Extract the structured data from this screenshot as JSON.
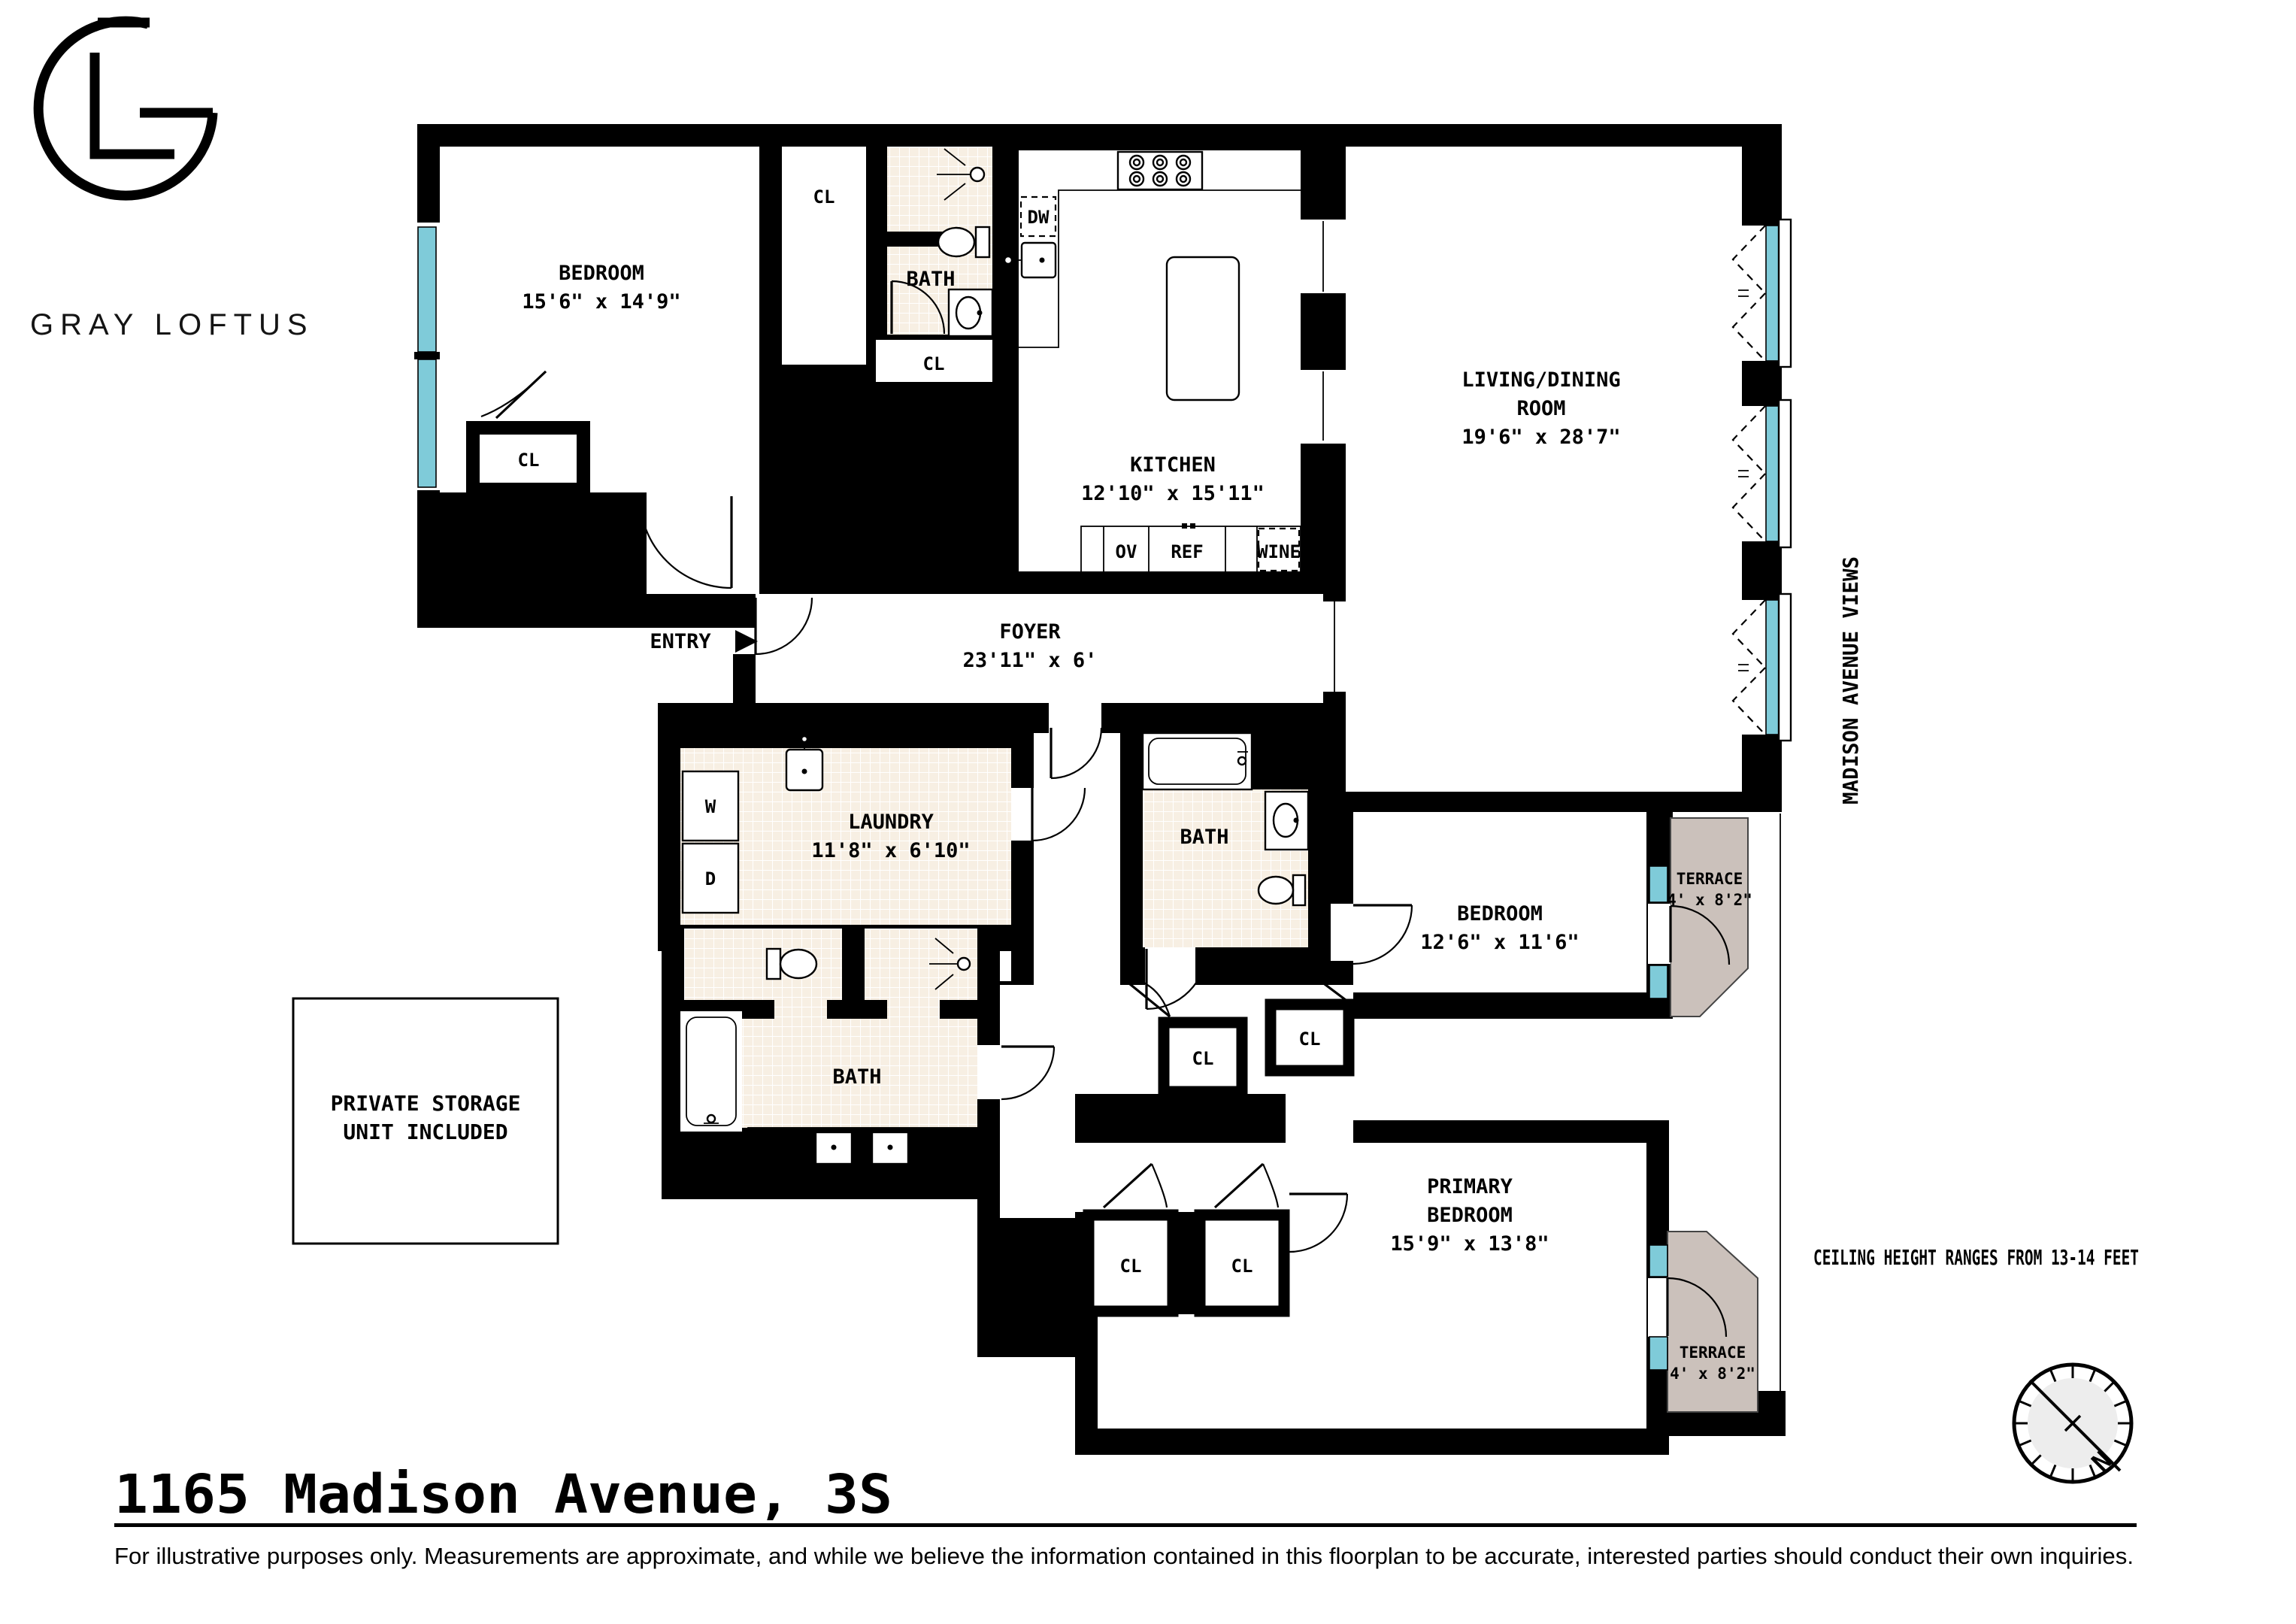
{
  "brand": {
    "name": "GRAY LOFTUS"
  },
  "rooms": {
    "bedroom_top": {
      "name": "BEDROOM",
      "dims": "15'6\" x 14'9\""
    },
    "bath_top": {
      "name": "BATH"
    },
    "kitchen": {
      "name": "KITCHEN",
      "dims": "12'10\" x 15'11\""
    },
    "living": {
      "name1": "LIVING/DINING",
      "name2": "ROOM",
      "dims": "19'6\" x 28'7\""
    },
    "foyer": {
      "name": "FOYER",
      "dims": "23'11\" x 6'"
    },
    "laundry": {
      "name": "LAUNDRY",
      "dims": "11'8\" x 6'10\""
    },
    "bath_mid": {
      "name": "BATH"
    },
    "bedroom_mid": {
      "name": "BEDROOM",
      "dims": "12'6\" x 11'6\""
    },
    "bath_primary": {
      "name": "BATH"
    },
    "primary_bedroom": {
      "name1": "PRIMARY",
      "name2": "BEDROOM",
      "dims": "15'9\" x 13'8\""
    },
    "terrace_upper": {
      "name": "TERRACE",
      "dims": "4' x 8'2\""
    },
    "terrace_lower": {
      "name": "TERRACE",
      "dims": "4' x 8'2\""
    }
  },
  "labels": {
    "closet": "CL",
    "entry": "ENTRY",
    "dishwasher": "DW",
    "oven": "OV",
    "refrigerator": "REF",
    "wine": "WINE",
    "washer": "W",
    "dryer": "D",
    "north": "N"
  },
  "annotations": {
    "views": "MADISON AVENUE VIEWS",
    "ceiling": "CEILING HEIGHT RANGES FROM 13-14 FEET",
    "storage1": "PRIVATE STORAGE",
    "storage2": "UNIT INCLUDED"
  },
  "footer": {
    "title": "1165 Madison Avenue, 3S",
    "disclaimer": "For illustrative purposes only.  Measurements are approximate, and while we believe the information contained in this floorplan to be accurate, interested parties should conduct their own inquiries."
  },
  "colors": {
    "wall": "#000000",
    "window": "#7fcbd9",
    "tile": "#f7efe3",
    "terrace": "#cbc1bb",
    "compass_face": "#ededed"
  }
}
